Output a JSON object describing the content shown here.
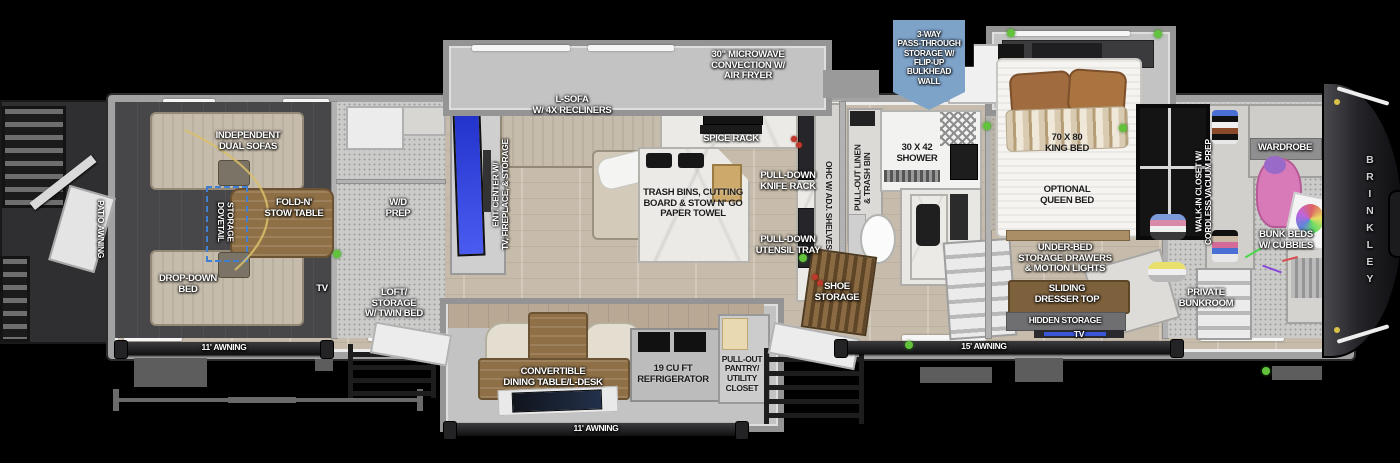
{
  "brand": "BRINKLEY",
  "callout": {
    "storage": "3-WAY\nPASS-THROUGH\nSTORAGE W/\nFLIP-UP\nBULKHEAD\nWALL",
    "bg_color": "#7ea3c9"
  },
  "garage": {
    "patio_awning": "PATIO AWNING",
    "dual_sofas": "INDEPENDENT\nDUAL SOFAS",
    "dovetail_storage": "DOVETAIL\nSTORAGE",
    "fold_table": "FOLD-N'\nSTOW TABLE",
    "drop_bed": "DROP-DOWN\nBED",
    "tv": "TV",
    "awning": "11' AWNING"
  },
  "loft": {
    "wd_prep": "W/D\nPREP",
    "storage": "LOFT/\nSTORAGE\nw/ TWIN BED"
  },
  "living": {
    "ent_center": "ENT. CENTER w/\nTV, FIREPLACE, & STORAGE",
    "sofa": "L-SOFA\nw/ 4x RECLINERS",
    "microwave": "30\" MICROWAVE\nCONVECTION w/\nAIR FRYER",
    "spice_rack": "SPICE RACK",
    "island": "TRASH BINS, CUTTING\nBOARD & STOW N' GO\nPAPER TOWEL",
    "knife_rack": "PULL-DOWN\nKNIFE RACK",
    "utensil_tray": "PULL-DOWN\nUTENSIL TRAY",
    "ohc": "OHC w/ ADJ. SHELVES"
  },
  "dinette": {
    "dining": "CONVERTIBLE\nDINING TABLE/L-DESK",
    "fridge": "19 CU FT\nREFRIGERATOR",
    "pantry": "PULL-OUT\nPANTRY/\nUTILITY\nCLOSET",
    "awning": "11' AWNING"
  },
  "bath": {
    "linen": "PULL-OUT LINEN\n& TRASH BIN",
    "shower": "30 x 42\nSHOWER",
    "shoe_storage": "SHOE\nSTORAGE"
  },
  "bedroom": {
    "king_bed": "70 x 80\nKING BED",
    "queen_bed": "OPTIONAL\nQUEEN BED",
    "under_bed": "UNDER-BED\nSTORAGE DRAWERS\n& MOTION LIGHTS",
    "dresser": "SLIDING\nDRESSER TOP",
    "hidden": "HIDDEN STORAGE",
    "tv": "TV",
    "awning": "15' AWNING"
  },
  "bunkroom": {
    "closet": "WALK-IN CLOSET w/\nCORDLESS VACUUM PREP",
    "wardrobe": "WARDROBE",
    "bunks": "BUNK BEDS\nw/ CUBBIES",
    "private": "PRIVATE\nBUNKROOM"
  },
  "colors": {
    "accent_green": "#63c23c",
    "dovetail_dash": "#3f7fd4",
    "tv_screen": "#2b3bd4",
    "callout_bg": "#7ea3c9",
    "body_wall": "#a2a2a2"
  }
}
